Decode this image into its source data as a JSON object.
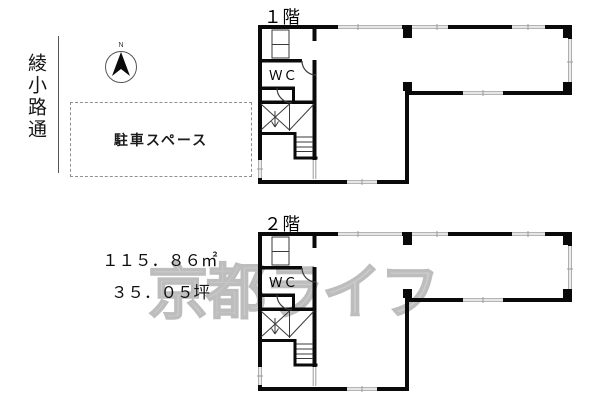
{
  "street": {
    "name": "綾小路通"
  },
  "compass": {
    "label": "N"
  },
  "parking": {
    "label": "駐車スペース"
  },
  "area": {
    "sqm": "１１５．８６㎡",
    "tsubo": "３５．０５坪"
  },
  "floors": [
    {
      "label": "１階",
      "wc": "ＷＣ"
    },
    {
      "label": "２階",
      "wc": "ＷＣ"
    }
  ],
  "watermark": {
    "text": "京都ライフ"
  },
  "colors": {
    "wall": "#0a0a0a",
    "window": "#9b9b9b",
    "thin": "#3a3a3a",
    "compass_ring": "#555555",
    "watermark": "#cbcbcb"
  }
}
